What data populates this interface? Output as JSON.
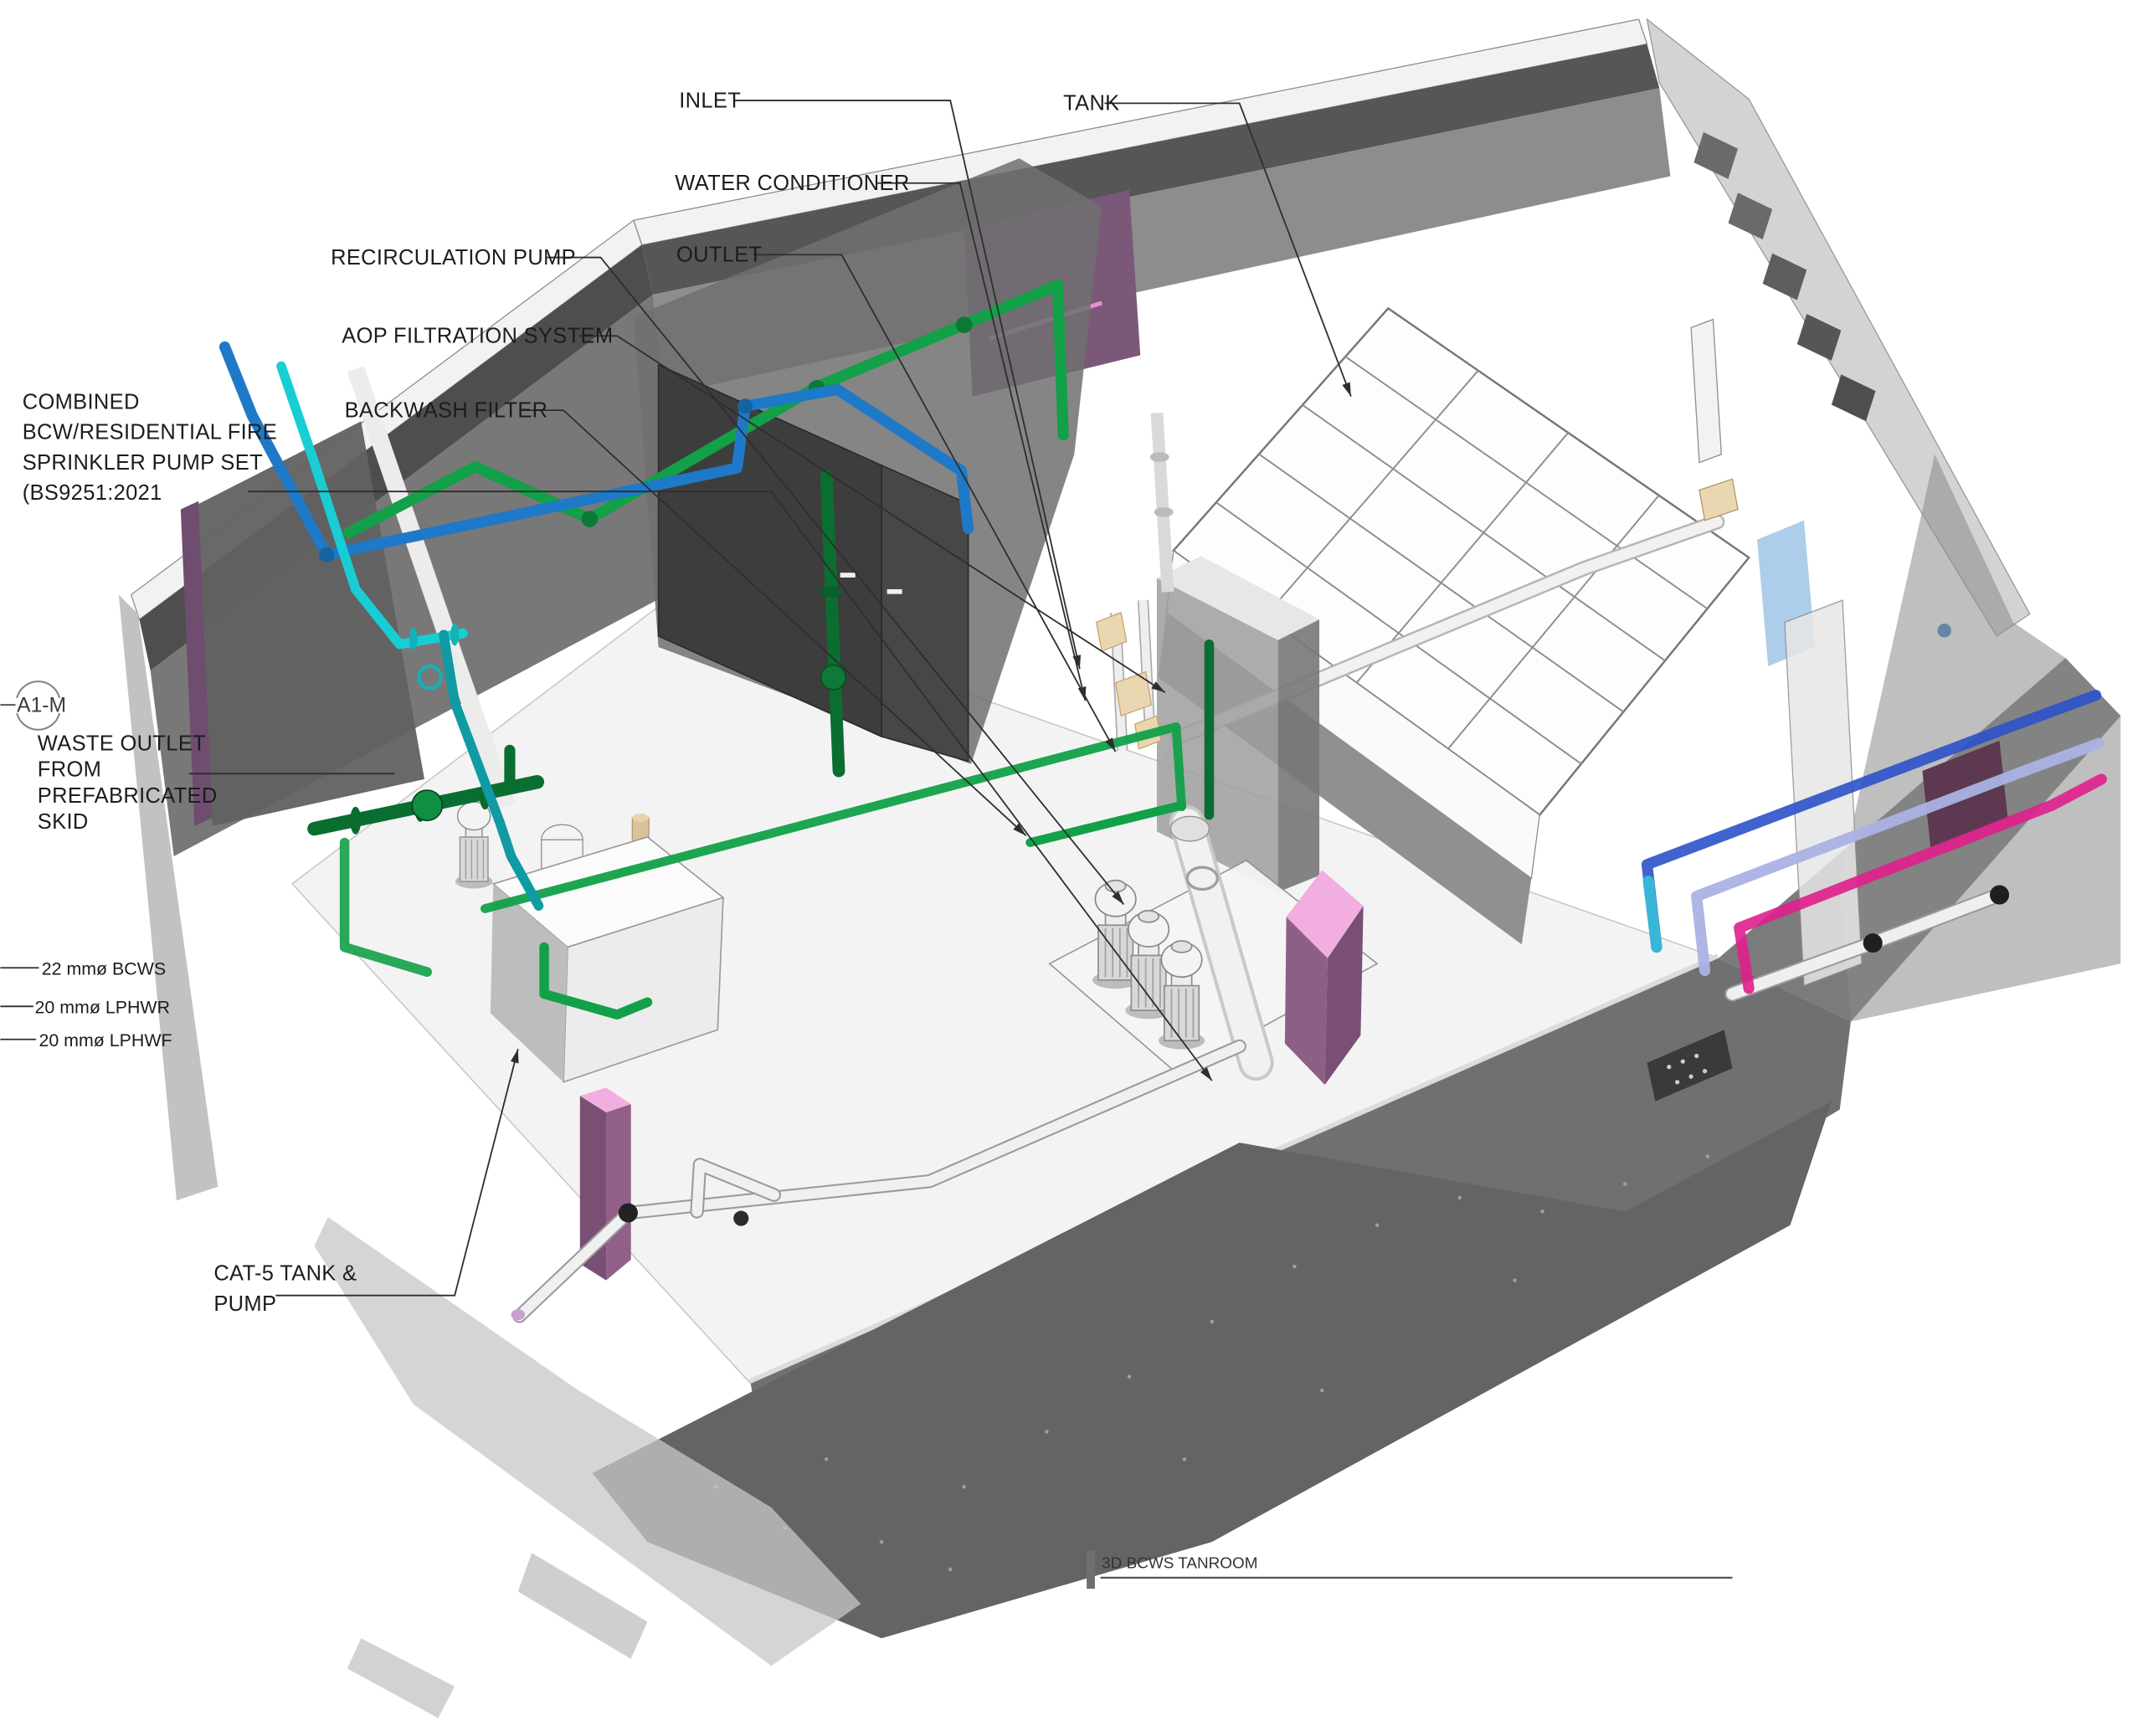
{
  "view": {
    "title": "3D BCWS TANROOM"
  },
  "callouts": {
    "inlet": "INLET",
    "water_conditioner": "WATER CONDITIONER",
    "outlet": "OUTLET",
    "recirculation_pump": "RECIRCULATION PUMP",
    "aop_filtration_system": "AOP FILTRATION SYSTEM",
    "backwash_filter": "BACKWASH FILTER",
    "combined_pump_set": [
      "COMBINED",
      "BCW/RESIDENTIAL FIRE",
      "SPRINKLER PUMP SET",
      "(BS9251:2021"
    ],
    "waste_outlet": [
      "WASTE OUTLET",
      "FROM",
      "PREFABRICATED",
      "SKID"
    ],
    "cat5_tank_pump": [
      "CAT-5 TANK &",
      "PUMP"
    ],
    "tank": "TANK"
  },
  "section_marker": "A1-M",
  "pipe_tags": [
    "22 mmø BCWS",
    "20 mmø LPHWR",
    "20 mmø LPHWF"
  ],
  "colors": {
    "pipe_green": "#12a048",
    "pipe_dark_green": "#0b6e31",
    "pipe_blue": "#1e79c8",
    "pipe_cyan": "#19cdd4",
    "pipe_teal": "#0f9aa4",
    "pipe_bcws": "#2b52c8",
    "pipe_lphwr": "#aab2e4",
    "pipe_lphwf": "#df1f8c",
    "wall_accent_purple": "#7b5878",
    "wall_edge_purple": "#6e4d6e",
    "equipment_pink": "#f2aee0",
    "valve_brass": "#ead6b0"
  }
}
